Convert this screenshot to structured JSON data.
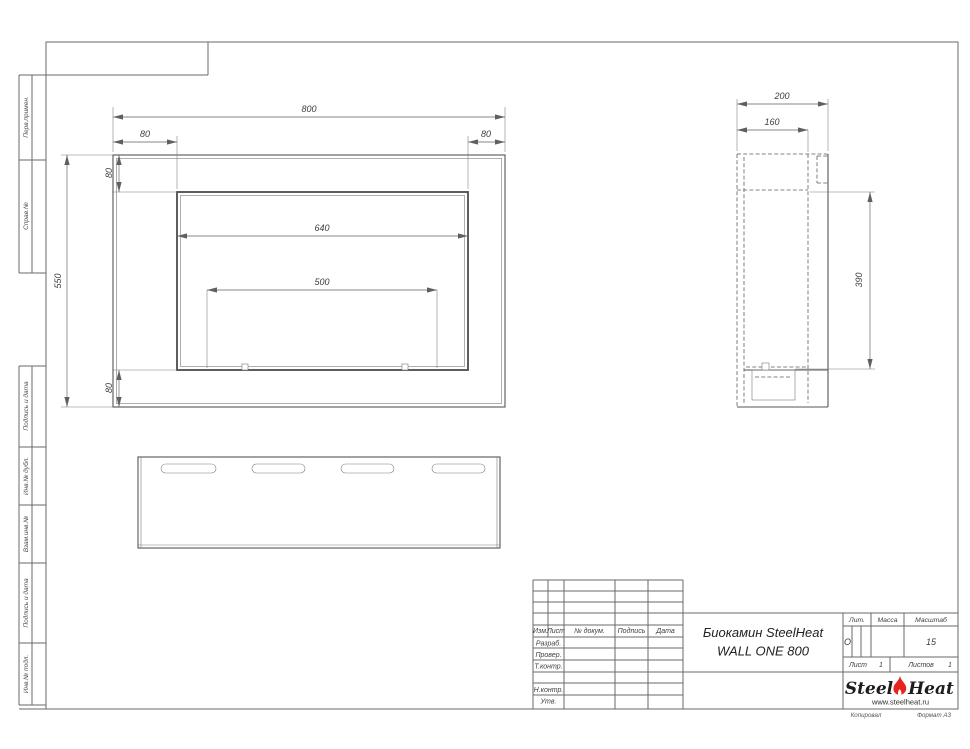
{
  "sidebar": {
    "items": [
      "Перв.примен.",
      "Справ.№",
      "Подпись и дата",
      "Инв.№ дубл.",
      "Взам.инв.№",
      "Подпись и дата",
      "Инв.№ подл."
    ]
  },
  "views": {
    "front": {
      "w": "800",
      "off_l": "80",
      "off_r": "80",
      "off_t": "80",
      "h": "550",
      "opening": "640",
      "burner": "500",
      "off_b": "80"
    },
    "side": {
      "d": "200",
      "d_in": "160",
      "h_op": "390"
    }
  },
  "tb": {
    "hdr": [
      "Изм.",
      "Лист",
      "№ докум.",
      "Подпись",
      "Дата"
    ],
    "rows": [
      "Разраб.",
      "Провер.",
      "Т.контр.",
      "Н.контр.",
      "Утв."
    ],
    "title1": "Биокамин SteelHeat",
    "title2": "WALL ONE 800",
    "lit": "Лит.",
    "lit_v": "О",
    "mass": "Масса",
    "scale": "Масштаб",
    "scale_v": "15",
    "sheet": "Лист",
    "sheet_v": "1",
    "sheets": "Листов",
    "sheets_v": "1"
  },
  "logo": {
    "p1": "Steel",
    "p2": "Heat",
    "url": "www.steelheat.ru",
    "flame": "#e8231e"
  },
  "footer": {
    "copy": "Копировал",
    "fmt": "Формат А3"
  }
}
